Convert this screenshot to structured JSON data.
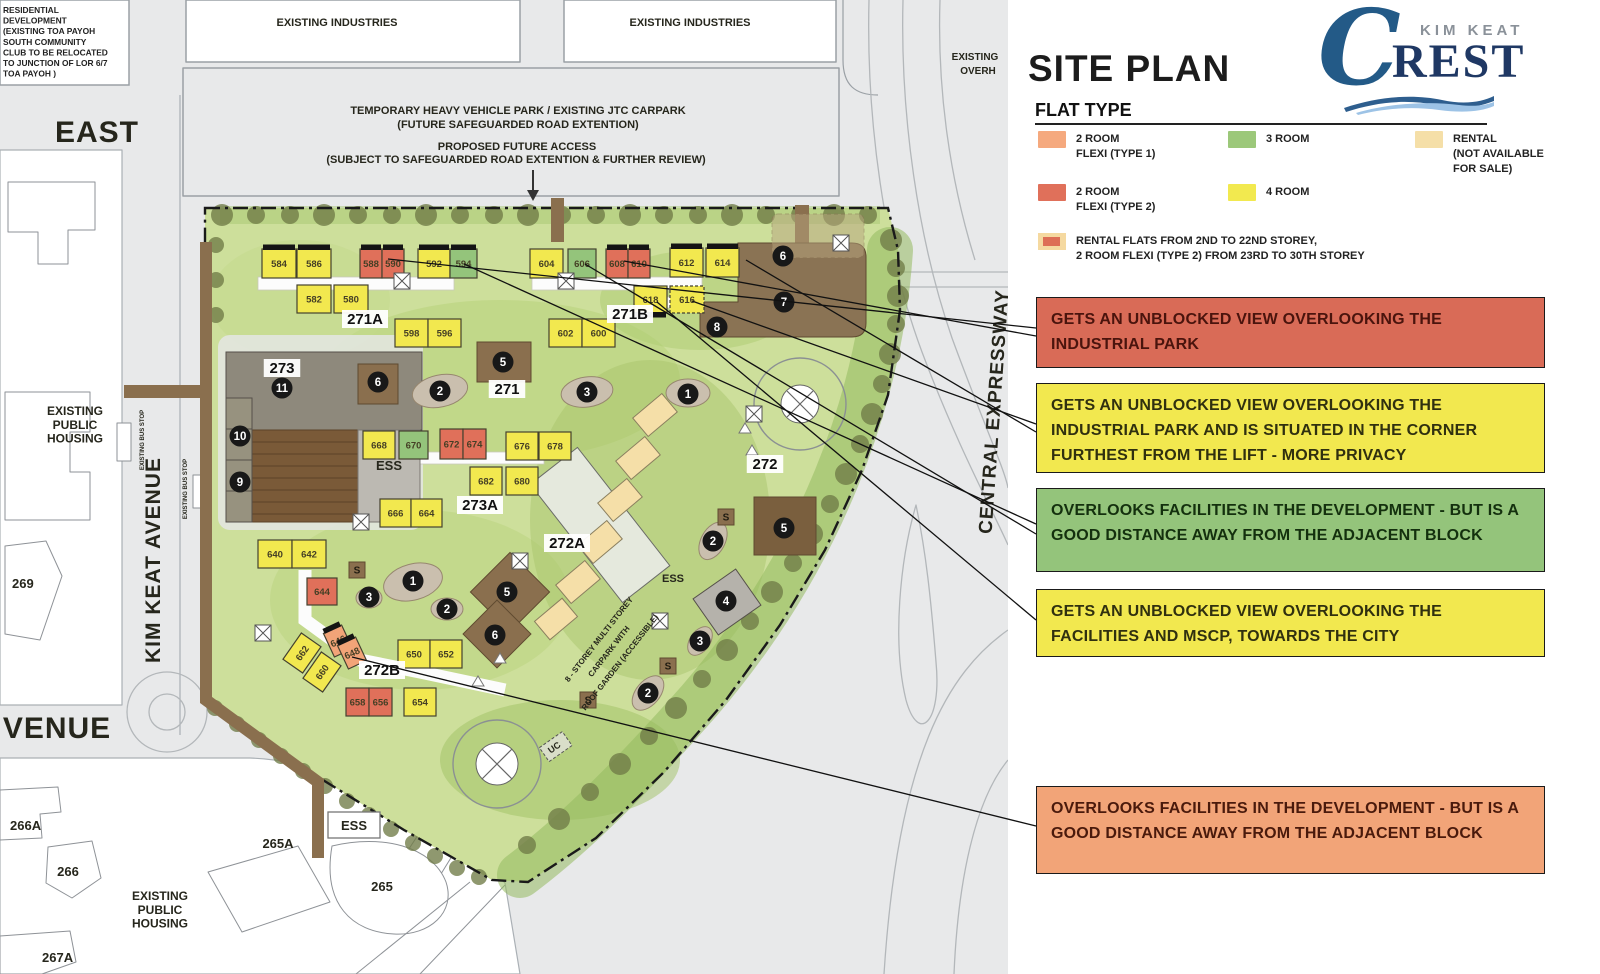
{
  "panel": {
    "title": "SITE PLAN",
    "legend_heading": "FLAT TYPE",
    "logo": {
      "brand_top": "KIM KEAT",
      "initial": "C",
      "brand_rest": "REST"
    },
    "legend": {
      "items": [
        {
          "name": "2-room-flexi-type-1",
          "label": "2 ROOM\nFLEXI (TYPE 1)",
          "color": "#F5A97E",
          "x": 26,
          "y": 131
        },
        {
          "name": "3-room",
          "label": "3 ROOM",
          "color": "#9CC87A",
          "x": 216,
          "y": 131
        },
        {
          "name": "rental",
          "label": "RENTAL\n(NOT AVAILABLE\nFOR SALE)",
          "color": "#F5DFA8",
          "x": 403,
          "y": 131
        },
        {
          "name": "2-room-flexi-type-2",
          "label": "2 ROOM\nFLEXI (TYPE 2)",
          "color": "#E0705A",
          "x": 26,
          "y": 184
        },
        {
          "name": "4-room",
          "label": "4 ROOM",
          "color": "#F2E94F",
          "x": 216,
          "y": 184
        }
      ],
      "special": {
        "label": "RENTAL FLATS FROM 2ND TO 22ND STOREY,\n2 ROOM FLEXI (TYPE 2) FROM 23RD TO 30TH STOREY",
        "outer": "#F5D9A0",
        "inner": "#DD6E55",
        "x": 26,
        "y": 233
      }
    },
    "callouts": [
      {
        "color": "#D96B57",
        "text_color": "#4A140D",
        "y": 297,
        "h": 71,
        "text": "GETS AN UNBLOCKED VIEW OVERLOOKING THE INDUSTRIAL PARK"
      },
      {
        "color": "#F2E84F",
        "text_color": "#30300F",
        "y": 383,
        "h": 90,
        "text": "GETS AN UNBLOCKED VIEW OVERLOOKING THE INDUSTRIAL PARK AND IS SITUATED IN THE CORNER FURTHEST FROM THE LIFT - MORE PRIVACY"
      },
      {
        "color": "#94C47B",
        "text_color": "#14300E",
        "y": 488,
        "h": 84,
        "text": "OVERLOOKS FACILITIES IN THE DEVELOPMENT - BUT IS A GOOD DISTANCE AWAY FROM THE ADJACENT BLOCK"
      },
      {
        "color": "#F2E84F",
        "text_color": "#30300F",
        "y": 589,
        "h": 68,
        "text": "GETS AN UNBLOCKED VIEW OVERLOOKING THE FACILITIES AND MSCP, TOWARDS THE CITY"
      },
      {
        "color": "#F2A478",
        "text_color": "#4A1A0C",
        "y": 786,
        "h": 88,
        "text": "OVERLOOKS FACILITIES IN THE DEVELOPMENT - BUT IS A GOOD DISTANCE AWAY FROM THE ADJACENT BLOCK"
      }
    ]
  },
  "map": {
    "note_topleft": [
      "RESIDENTIAL",
      "DEVELOPMENT",
      "(EXISTING TOA PAYOH",
      "SOUTH COMMUNITY",
      "CLUB TO BE RELOCATED",
      "TO JUNCTION OF LOR 6/7",
      "TOA PAYOH )"
    ],
    "labels": [
      {
        "t": "EXISTING INDUSTRIES",
        "x": 337,
        "y": 26,
        "s": 11
      },
      {
        "t": "EXISTING INDUSTRIES",
        "x": 690,
        "y": 26,
        "s": 11
      },
      {
        "t": "EAST",
        "x": 97,
        "y": 142,
        "s": 30
      },
      {
        "t": "VENUE",
        "x": 57,
        "y": 738,
        "s": 30
      },
      {
        "t": "KIM KEAT AVENUE",
        "x": 160,
        "y": 560,
        "s": 21,
        "rot": -90
      },
      {
        "t": "CENTRAL EXPRESSWAY",
        "x": 1000,
        "y": 412,
        "s": 19,
        "rot": -86
      },
      {
        "t": "EXISTING\nPUBLIC\nHOUSING",
        "x": 75,
        "y": 415,
        "s": 12
      },
      {
        "t": "EXISTING\nPUBLIC\nHOUSING",
        "x": 160,
        "y": 900,
        "s": 12
      },
      {
        "t": "269",
        "x": 12,
        "y": 588,
        "s": 13,
        "anchor": "start"
      },
      {
        "t": "266A",
        "x": 10,
        "y": 830,
        "s": 13,
        "anchor": "start"
      },
      {
        "t": "266",
        "x": 68,
        "y": 876,
        "s": 13
      },
      {
        "t": "265A",
        "x": 278,
        "y": 848,
        "s": 13
      },
      {
        "t": "265",
        "x": 382,
        "y": 891,
        "s": 13
      },
      {
        "t": "267A",
        "x": 42,
        "y": 962,
        "s": 13,
        "anchor": "start"
      },
      {
        "t": "EXISTING",
        "x": 975,
        "y": 60,
        "s": 10
      },
      {
        "t": "OVERH",
        "x": 978,
        "y": 74,
        "s": 10
      },
      {
        "t": "EXISTING BUS STOP",
        "x": 144,
        "y": 440,
        "s": 6,
        "rot": -90
      },
      {
        "t": "EXISTING BUS STOP",
        "x": 187,
        "y": 489,
        "s": 6,
        "rot": -90
      },
      {
        "t": "TEMPORARY HEAVY VEHICLE PARK / EXISTING JTC CARPARK",
        "x": 518,
        "y": 114,
        "s": 11
      },
      {
        "t": "(FUTURE SAFEGUARDED ROAD EXTENTION)",
        "x": 518,
        "y": 128,
        "s": 11
      },
      {
        "t": "PROPOSED FUTURE ACCESS",
        "x": 517,
        "y": 150,
        "s": 11
      },
      {
        "t": "(SUBJECT TO SAFEGUARDED ROAD EXTENTION & FURTHER REVIEW)",
        "x": 516,
        "y": 163,
        "s": 11
      },
      {
        "t": "8 - STOREY MULTI STOREY",
        "x": 601,
        "y": 641,
        "s": 8,
        "rot": -52
      },
      {
        "t": "CARPARK WITH",
        "x": 611,
        "y": 653,
        "s": 8,
        "rot": -52
      },
      {
        "t": "ROOF GARDEN (ACCESSIBLE)",
        "x": 622,
        "y": 664,
        "s": 8,
        "rot": -52
      },
      {
        "t": "UC",
        "x": 556,
        "y": 750,
        "s": 9,
        "rot": -35
      },
      {
        "t": "ESS",
        "x": 389,
        "y": 470,
        "s": 13
      },
      {
        "t": "ESS",
        "x": 673,
        "y": 582,
        "s": 11
      },
      {
        "t": "ESS",
        "x": 354,
        "y": 830,
        "s": 13
      }
    ],
    "block_labels": [
      {
        "t": "271A",
        "x": 365,
        "y": 323
      },
      {
        "t": "271B",
        "x": 630,
        "y": 318
      },
      {
        "t": "271",
        "x": 507,
        "y": 393
      },
      {
        "t": "273",
        "x": 282,
        "y": 372
      },
      {
        "t": "273A",
        "x": 480,
        "y": 509
      },
      {
        "t": "272A",
        "x": 567,
        "y": 547
      },
      {
        "t": "272B",
        "x": 382,
        "y": 674
      },
      {
        "t": "272",
        "x": 765,
        "y": 468
      }
    ],
    "buildings": [
      {
        "no": "584",
        "x": 262,
        "y": 249,
        "w": 34,
        "h": 29,
        "t": "y",
        "bar": "top"
      },
      {
        "no": "586",
        "x": 297,
        "y": 249,
        "w": 34,
        "h": 29,
        "t": "y",
        "bar": "top"
      },
      {
        "no": "588",
        "x": 360,
        "y": 249,
        "w": 22,
        "h": 29,
        "t": "r",
        "bar": "top"
      },
      {
        "no": "590",
        "x": 382,
        "y": 249,
        "w": 22,
        "h": 29,
        "t": "r",
        "bar": "top"
      },
      {
        "no": "592",
        "x": 418,
        "y": 249,
        "w": 32,
        "h": 29,
        "t": "y",
        "bar": "top"
      },
      {
        "no": "594",
        "x": 450,
        "y": 249,
        "w": 27,
        "h": 29,
        "t": "g",
        "bar": "top"
      },
      {
        "no": "604",
        "x": 530,
        "y": 249,
        "w": 33,
        "h": 29,
        "t": "y"
      },
      {
        "no": "606",
        "x": 568,
        "y": 249,
        "w": 28,
        "h": 29,
        "t": "g"
      },
      {
        "no": "608",
        "x": 606,
        "y": 249,
        "w": 22,
        "h": 29,
        "t": "r",
        "bar": "top"
      },
      {
        "no": "610",
        "x": 628,
        "y": 249,
        "w": 22,
        "h": 29,
        "t": "r",
        "bar": "top"
      },
      {
        "no": "612",
        "x": 670,
        "y": 248,
        "w": 33,
        "h": 29,
        "t": "y",
        "bar": "top"
      },
      {
        "no": "614",
        "x": 706,
        "y": 248,
        "w": 33,
        "h": 29,
        "t": "y",
        "bar": "top"
      },
      {
        "no": "582",
        "x": 297,
        "y": 285,
        "w": 34,
        "h": 28,
        "t": "y"
      },
      {
        "no": "580",
        "x": 334,
        "y": 285,
        "w": 34,
        "h": 28,
        "t": "y"
      },
      {
        "no": "598",
        "x": 395,
        "y": 319,
        "w": 33,
        "h": 28,
        "t": "y"
      },
      {
        "no": "596",
        "x": 428,
        "y": 319,
        "w": 33,
        "h": 28,
        "t": "y"
      },
      {
        "no": "602",
        "x": 549,
        "y": 319,
        "w": 33,
        "h": 28,
        "t": "y"
      },
      {
        "no": "600",
        "x": 582,
        "y": 319,
        "w": 33,
        "h": 28,
        "t": "y"
      },
      {
        "no": "618",
        "x": 634,
        "y": 286,
        "w": 33,
        "h": 27,
        "t": "y",
        "bar": "bottom"
      },
      {
        "no": "616",
        "x": 670,
        "y": 286,
        "w": 34,
        "h": 27,
        "t": "y",
        "dash": 1
      },
      {
        "no": "668",
        "x": 363,
        "y": 431,
        "w": 32,
        "h": 28,
        "t": "y"
      },
      {
        "no": "670",
        "x": 399,
        "y": 431,
        "w": 29,
        "h": 28,
        "t": "g"
      },
      {
        "no": "672",
        "x": 440,
        "y": 429,
        "w": 23,
        "h": 30,
        "t": "r"
      },
      {
        "no": "674",
        "x": 463,
        "y": 429,
        "w": 23,
        "h": 30,
        "t": "r"
      },
      {
        "no": "676",
        "x": 506,
        "y": 432,
        "w": 32,
        "h": 28,
        "t": "y"
      },
      {
        "no": "678",
        "x": 539,
        "y": 432,
        "w": 32,
        "h": 28,
        "t": "y"
      },
      {
        "no": "682",
        "x": 470,
        "y": 467,
        "w": 32,
        "h": 28,
        "t": "y"
      },
      {
        "no": "680",
        "x": 506,
        "y": 467,
        "w": 32,
        "h": 28,
        "t": "y"
      },
      {
        "no": "666",
        "x": 380,
        "y": 499,
        "w": 31,
        "h": 28,
        "t": "y"
      },
      {
        "no": "664",
        "x": 411,
        "y": 499,
        "w": 31,
        "h": 28,
        "t": "y"
      },
      {
        "no": "640",
        "x": 258,
        "y": 540,
        "w": 34,
        "h": 28,
        "t": "y"
      },
      {
        "no": "642",
        "x": 292,
        "y": 540,
        "w": 34,
        "h": 28,
        "t": "y"
      },
      {
        "no": "644",
        "x": 307,
        "y": 578,
        "w": 30,
        "h": 27,
        "t": "r"
      },
      {
        "no": "662",
        "x": 286,
        "y": 641,
        "w": 32,
        "h": 24,
        "t": "y",
        "rot": -55
      },
      {
        "no": "660",
        "x": 306,
        "y": 660,
        "w": 32,
        "h": 24,
        "t": "y",
        "rot": -55
      },
      {
        "no": "646",
        "x": 328,
        "y": 628,
        "w": 20,
        "h": 26,
        "t": "o",
        "bar": "top",
        "rot": -25
      },
      {
        "no": "648",
        "x": 342,
        "y": 640,
        "w": 20,
        "h": 26,
        "t": "o",
        "bar": "top",
        "rot": -25
      },
      {
        "no": "650",
        "x": 398,
        "y": 640,
        "w": 32,
        "h": 28,
        "t": "y"
      },
      {
        "no": "652",
        "x": 430,
        "y": 640,
        "w": 32,
        "h": 28,
        "t": "y"
      },
      {
        "no": "658",
        "x": 346,
        "y": 688,
        "w": 23,
        "h": 28,
        "t": "r"
      },
      {
        "no": "656",
        "x": 369,
        "y": 688,
        "w": 23,
        "h": 28,
        "t": "r"
      },
      {
        "no": "654",
        "x": 404,
        "y": 688,
        "w": 32,
        "h": 28,
        "t": "y"
      }
    ],
    "rental_blocks": [
      {
        "x": 643,
        "y": 396,
        "w": 24,
        "h": 38,
        "rot": 50
      },
      {
        "x": 626,
        "y": 439,
        "w": 24,
        "h": 38,
        "rot": 50
      },
      {
        "x": 608,
        "y": 481,
        "w": 24,
        "h": 38,
        "rot": 50
      },
      {
        "x": 588,
        "y": 523,
        "w": 24,
        "h": 38,
        "rot": 50
      },
      {
        "x": 566,
        "y": 563,
        "w": 24,
        "h": 38,
        "rot": 50
      },
      {
        "x": 544,
        "y": 601,
        "w": 24,
        "h": 36,
        "rot": 50
      }
    ],
    "facility_circles": [
      {
        "n": "6",
        "x": 783,
        "y": 256
      },
      {
        "n": "7",
        "x": 784,
        "y": 302
      },
      {
        "n": "8",
        "x": 717,
        "y": 327
      },
      {
        "n": "6",
        "x": 378,
        "y": 382
      },
      {
        "n": "5",
        "x": 503,
        "y": 362
      },
      {
        "n": "2",
        "x": 440,
        "y": 391
      },
      {
        "n": "3",
        "x": 587,
        "y": 392
      },
      {
        "n": "1",
        "x": 688,
        "y": 394
      },
      {
        "n": "11",
        "x": 282,
        "y": 388
      },
      {
        "n": "10",
        "x": 240,
        "y": 436
      },
      {
        "n": "9",
        "x": 240,
        "y": 482
      },
      {
        "n": "1",
        "x": 413,
        "y": 581
      },
      {
        "n": "3",
        "x": 369,
        "y": 597
      },
      {
        "n": "2",
        "x": 447,
        "y": 609
      },
      {
        "n": "5",
        "x": 507,
        "y": 592
      },
      {
        "n": "6",
        "x": 495,
        "y": 635
      },
      {
        "n": "5",
        "x": 784,
        "y": 528
      },
      {
        "n": "2",
        "x": 713,
        "y": 541
      },
      {
        "n": "4",
        "x": 726,
        "y": 601
      },
      {
        "n": "3",
        "x": 700,
        "y": 641
      },
      {
        "n": "2",
        "x": 648,
        "y": 693
      }
    ],
    "s_markers": [
      [
        357,
        570
      ],
      [
        726,
        517
      ],
      [
        668,
        666
      ],
      [
        588,
        700
      ]
    ],
    "x_boxes": [
      [
        402,
        281
      ],
      [
        566,
        281
      ],
      [
        841,
        243
      ],
      [
        520,
        561
      ],
      [
        754,
        414
      ],
      [
        660,
        621
      ],
      [
        263,
        633
      ],
      [
        361,
        522
      ]
    ],
    "ess_box": {
      "x": 328,
      "y": 812,
      "w": 52,
      "h": 26
    },
    "leader_lines": [
      [
        388,
        259,
        1036,
        328
      ],
      [
        624,
        261,
        1036,
        336
      ],
      [
        692,
        301,
        1036,
        424
      ],
      [
        746,
        260,
        1036,
        432
      ],
      [
        464,
        264,
        1036,
        524
      ],
      [
        585,
        264,
        1036,
        534
      ],
      [
        657,
        302,
        1036,
        620
      ],
      [
        352,
        657,
        1036,
        826
      ]
    ]
  },
  "colors": {
    "unit_y": "#F2E84F",
    "unit_g": "#94C47B",
    "unit_r": "#E0705A",
    "unit_o": "#F2A478",
    "unit_c": "#F5DFA8",
    "facility_brown": "#8A6F4E",
    "site_green": "#CDDF9B",
    "road_gray": "#E8E9EA",
    "logo_blue": "#235A87",
    "logo_navy": "#1F3864",
    "logo_gray": "#8A9199",
    "wave_light": "#9DC3E6"
  }
}
